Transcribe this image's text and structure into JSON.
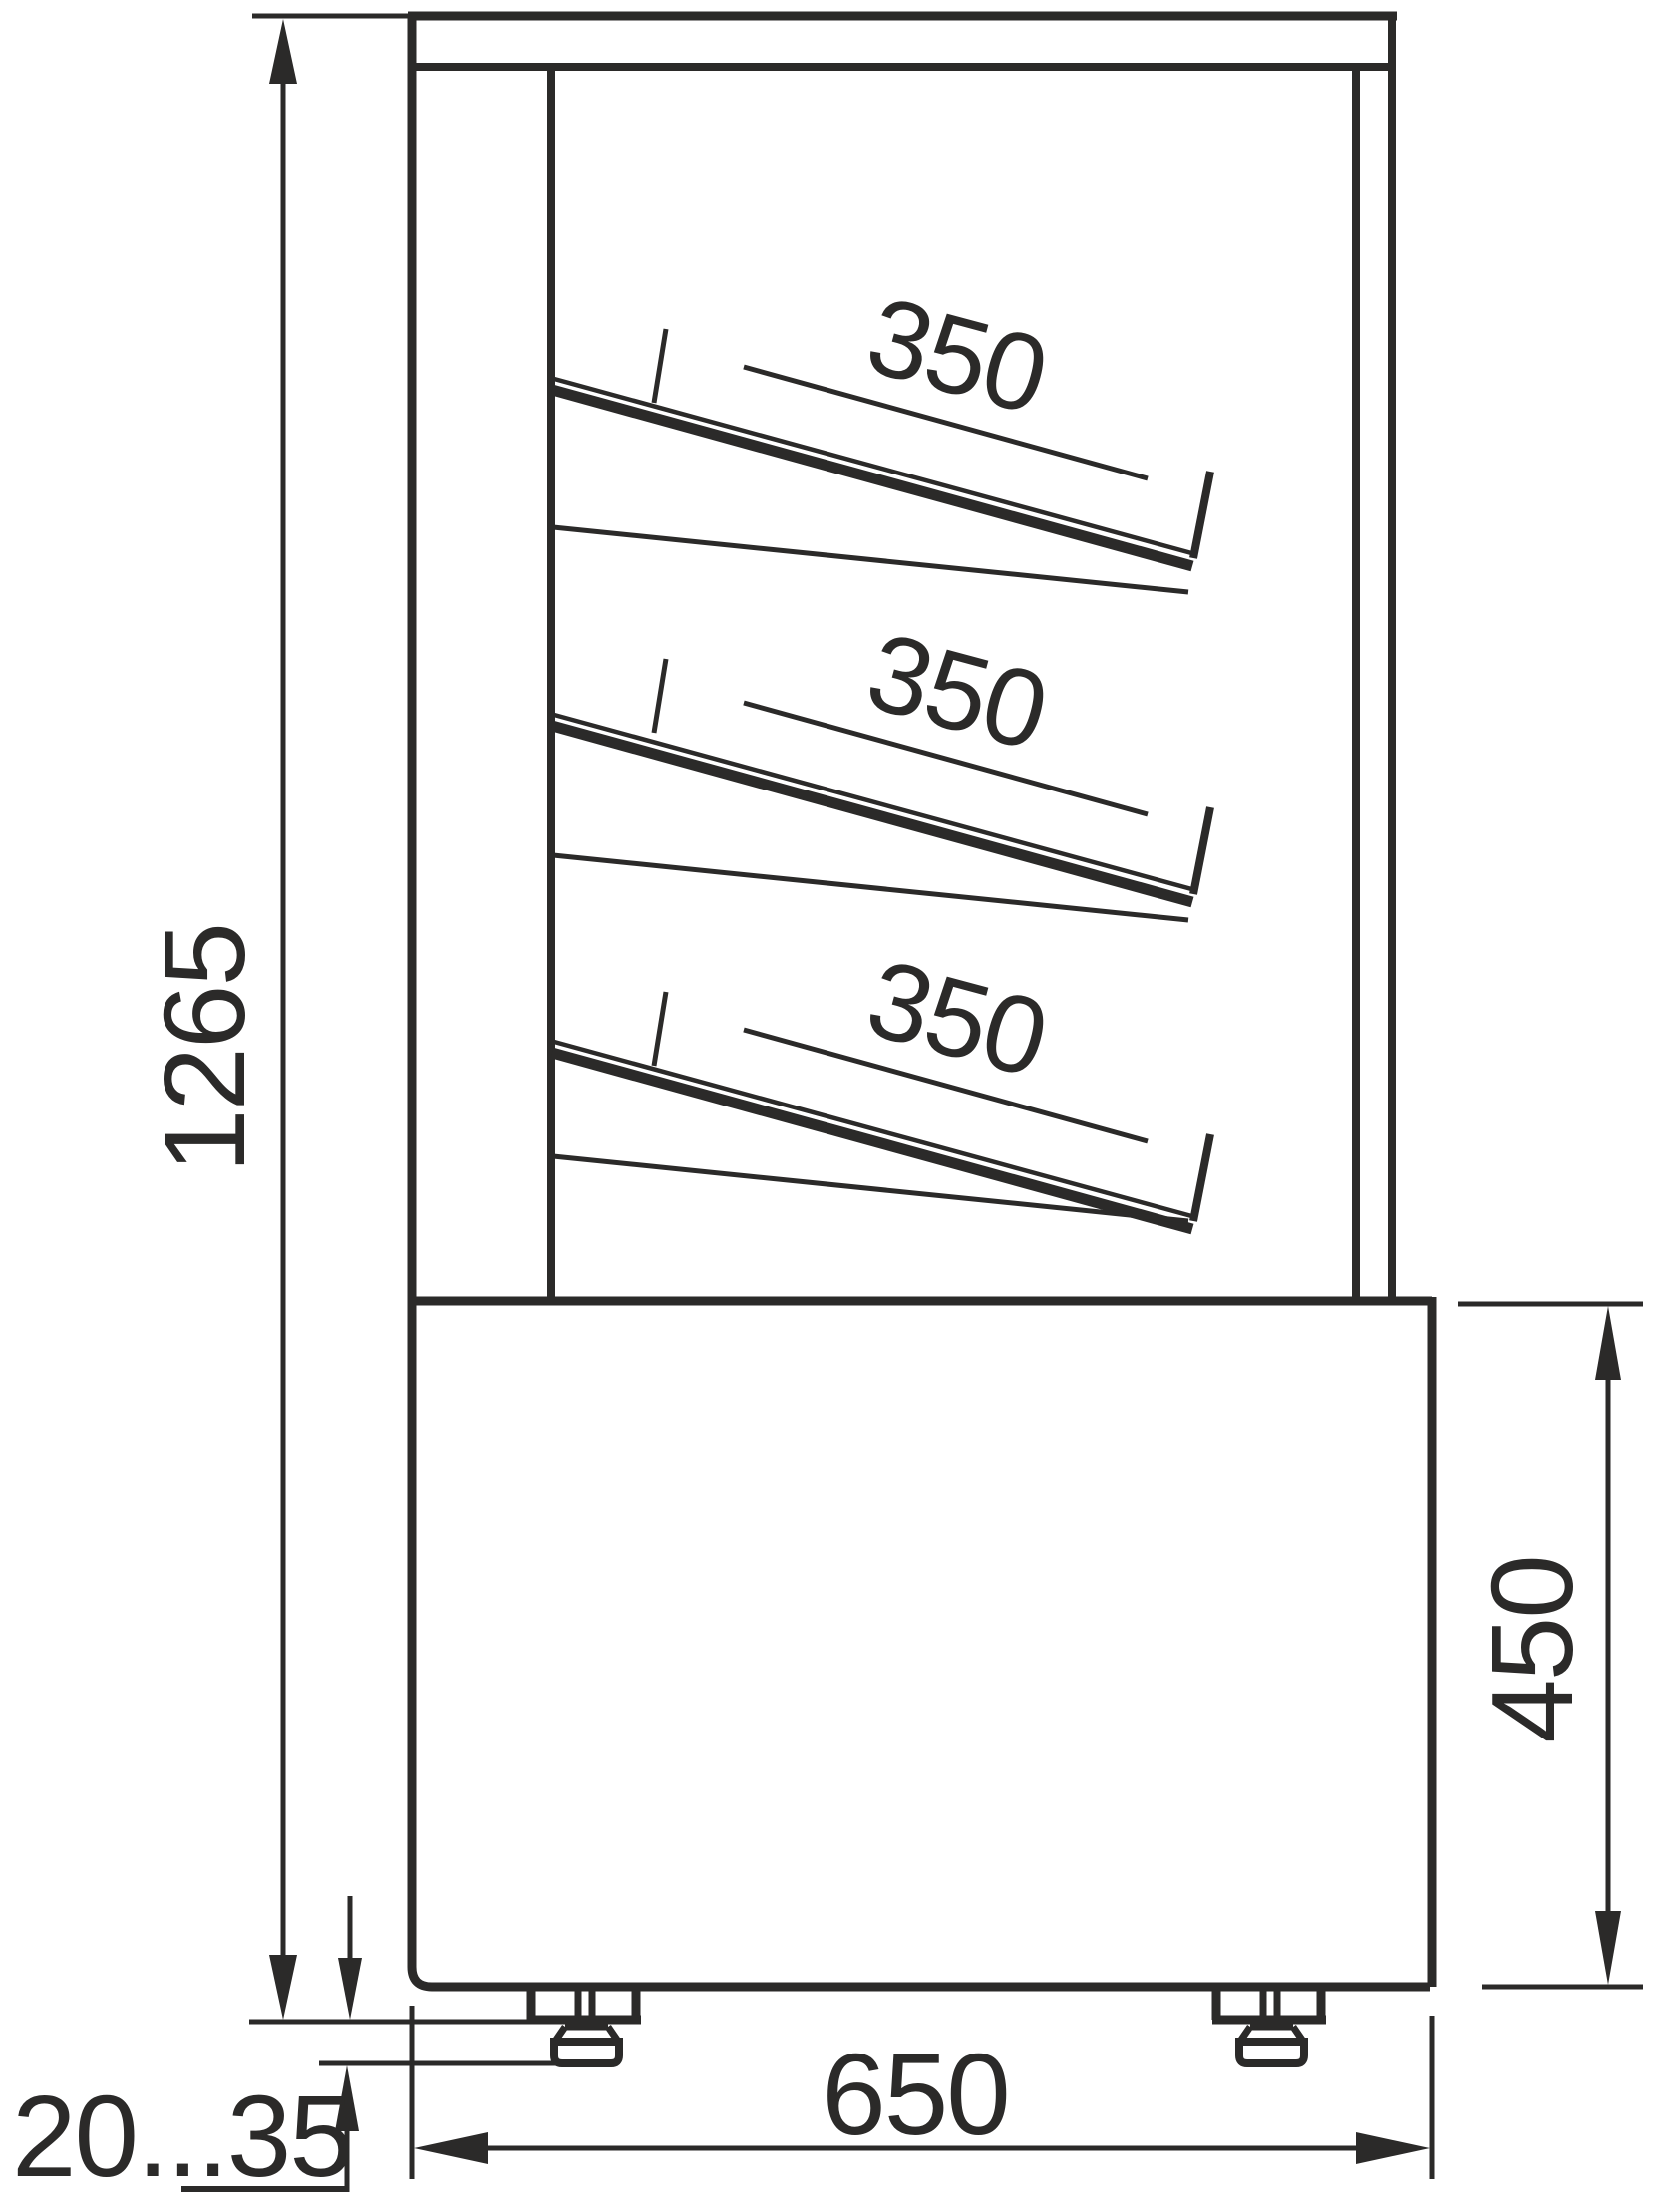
{
  "drawing": {
    "type": "technical-side-view-of-refrigerated-display-case",
    "background": "#ffffff",
    "line_color": "#2b2a29",
    "dimensions": {
      "overall_height": "1265",
      "shelf_labels": [
        "350",
        "350",
        "350"
      ],
      "base_height": "450",
      "base_width": "650",
      "feet_adjustment": "20...35"
    }
  }
}
